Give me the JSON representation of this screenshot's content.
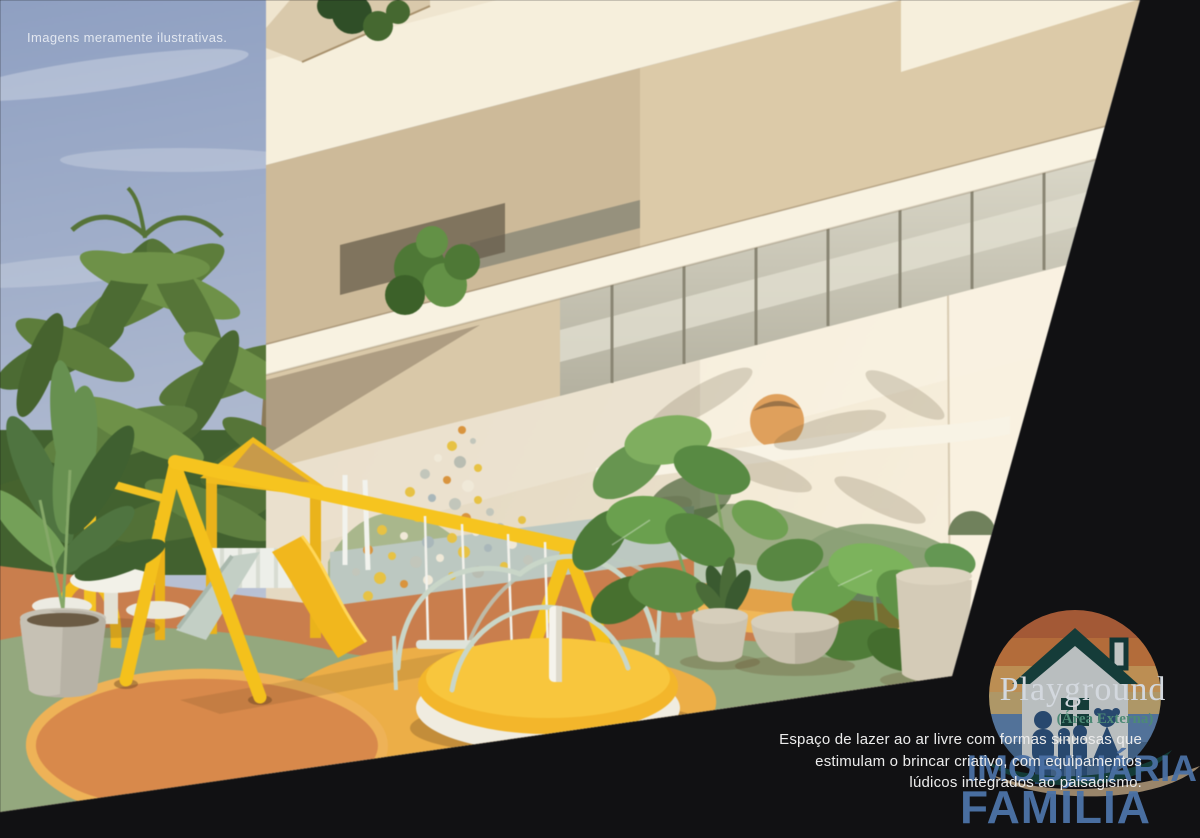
{
  "note": {
    "text": "Imagens meramente ilustrativas."
  },
  "caption": {
    "title": "Playground",
    "subtitle": "(Área Externa)",
    "description_lines": [
      "Espaço de lazer ao ar livre com formas sinuosas que",
      "estimulam o brincar criativo, com equipamentos",
      "lúdicos integrados ao paisagismo."
    ]
  },
  "brand": {
    "line1": "IMOBILIÁRIA",
    "line2": "FAMÍLIA",
    "logo_icon": "house-family-sunset-logo",
    "colors": {
      "watermark_blue": "#4a72a6",
      "logo_teal": "#16413e",
      "logo_orange": "#c5763f",
      "logo_sky_blue": "#5a7da8",
      "logo_tan": "#a89274",
      "subtitle_green": "#4d8a76"
    }
  },
  "scene": {
    "elements": [
      "sky",
      "palm-trees",
      "building-facade",
      "balcony-glass-railing",
      "balcony-plants",
      "climbing-wall",
      "wall-sun-mural",
      "wall-hills-mural",
      "swing-set",
      "play-tower-slide",
      "merry-go-round",
      "picnic-table",
      "banana-plant",
      "monstera-plants",
      "potted-plants",
      "curvy-rubber-floor"
    ],
    "palette": {
      "sky": "#9fadc8",
      "facade_cream": "#f2e8d4",
      "slab_beige": "#dccaa8",
      "play_yellow": "#f3bd1f",
      "floor_terracotta": "#c97e4d",
      "floor_sage": "#94a87e",
      "floor_amber": "#ecae47",
      "mint_band": "#bcc8c1",
      "foliage_green": "#5d8a42",
      "background_black": "#111113"
    }
  }
}
